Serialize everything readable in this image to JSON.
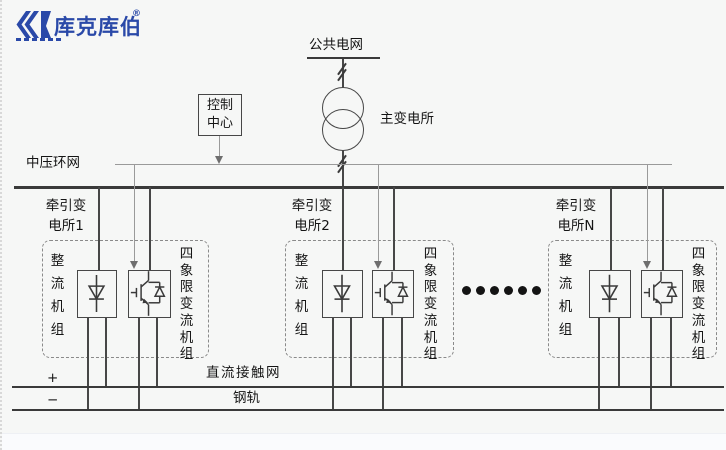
{
  "colors": {
    "brand_blue": "#2a49a8",
    "line_dark": "#3a3a3a",
    "line_gray": "#9a9a9a",
    "text": "#151515"
  },
  "logo": {
    "brand": "库克库伯",
    "registered": "®"
  },
  "grid": {
    "public_grid": "公共电网",
    "main_substation": "主变电所",
    "control_center": "控制\n中心",
    "mv_ring": "中压环网"
  },
  "substations": [
    {
      "title": "牵引变\n电所1",
      "rectifier_unit": "整流机组",
      "four_quadrant_unit": "四象限变流机组"
    },
    {
      "title": "牵引变\n电所2",
      "rectifier_unit": "整流机组",
      "four_quadrant_unit": "四象限变流机组"
    },
    {
      "title": "牵引变\n电所N",
      "rectifier_unit": "整流机组",
      "four_quadrant_unit": "四象限变流机组"
    }
  ],
  "ellipsis_dots": 6,
  "dc": {
    "plus": "+",
    "minus": "−",
    "catenary": "直流接触网",
    "rail": "钢轨"
  }
}
